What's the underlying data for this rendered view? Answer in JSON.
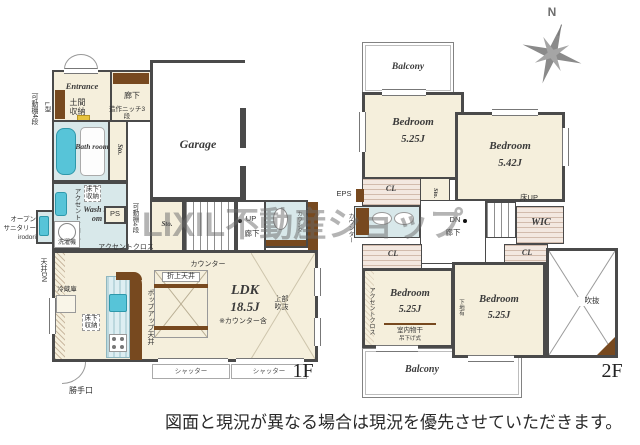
{
  "watermark": "LIXIL不動産ショップ",
  "disclaimer": "図面と現況が異なる場合は現況を優先させていただきます。",
  "compass": {
    "north": "N"
  },
  "floor1": {
    "floor_label": "1F",
    "entrance": {
      "name": "Entrance",
      "doma_storage": "土間収納",
      "shelf": "可動棚4段",
      "shelf_type": "L型"
    },
    "hallway": {
      "name": "廊下",
      "niche": "造作ニッチ3段"
    },
    "bath": {
      "name": "Bath room",
      "storage": "Sto."
    },
    "wash": {
      "name": "Wash room",
      "accent_cloth": "アクセントクロス",
      "floor_storage": "床下収納",
      "pipe_space": "PS",
      "washer": "洗濯機"
    },
    "sanitary": {
      "line1": "オープン",
      "line2": "サニタリー",
      "line3": "irodori"
    },
    "ceiling_down": "天井DN",
    "garage": {
      "name": "Garage"
    },
    "hall_center": {
      "storage": "Sto.",
      "stairs_up": "UP",
      "name": "廊下",
      "toilet_counter": "カウンター",
      "shelf": "可動棚4段"
    },
    "ldk": {
      "name": "LDK",
      "size": "18.5J",
      "size_note": "※カウンター含",
      "accent_cloth": "アクセントクロス",
      "counter": "カウンター",
      "raised_ceiling": "折上天井",
      "popup_ceiling": "ポップアップ天井",
      "fridge": "冷蔵庫",
      "floor_storage": "床下収納",
      "upper_void": "上部吹抜"
    },
    "openings": {
      "back_door": "勝手口",
      "shutter": "シャッター"
    }
  },
  "floor2": {
    "floor_label": "2F",
    "balcony": "Balcony",
    "bedrooms": [
      {
        "name": "Bedroom",
        "size": "5.25J"
      },
      {
        "name": "Bedroom",
        "size": "5.42J"
      },
      {
        "name": "Bedroom",
        "size": "5.25J",
        "laundry": "室内物干",
        "laundry_type": "吊下げ式",
        "accent_cloth": "アクセントクロス"
      },
      {
        "name": "Bedroom",
        "size": "5.25J",
        "wall_note": "下地有"
      }
    ],
    "closet": "CL",
    "storage": "Sto.",
    "wic": "WIC",
    "hall": {
      "stairs_dn": "DN",
      "name": "廊下",
      "counter": "カウンター",
      "eps": "EPS",
      "floor_up": "床UP",
      "duct_space": "DS"
    },
    "void": "吹抜"
  }
}
